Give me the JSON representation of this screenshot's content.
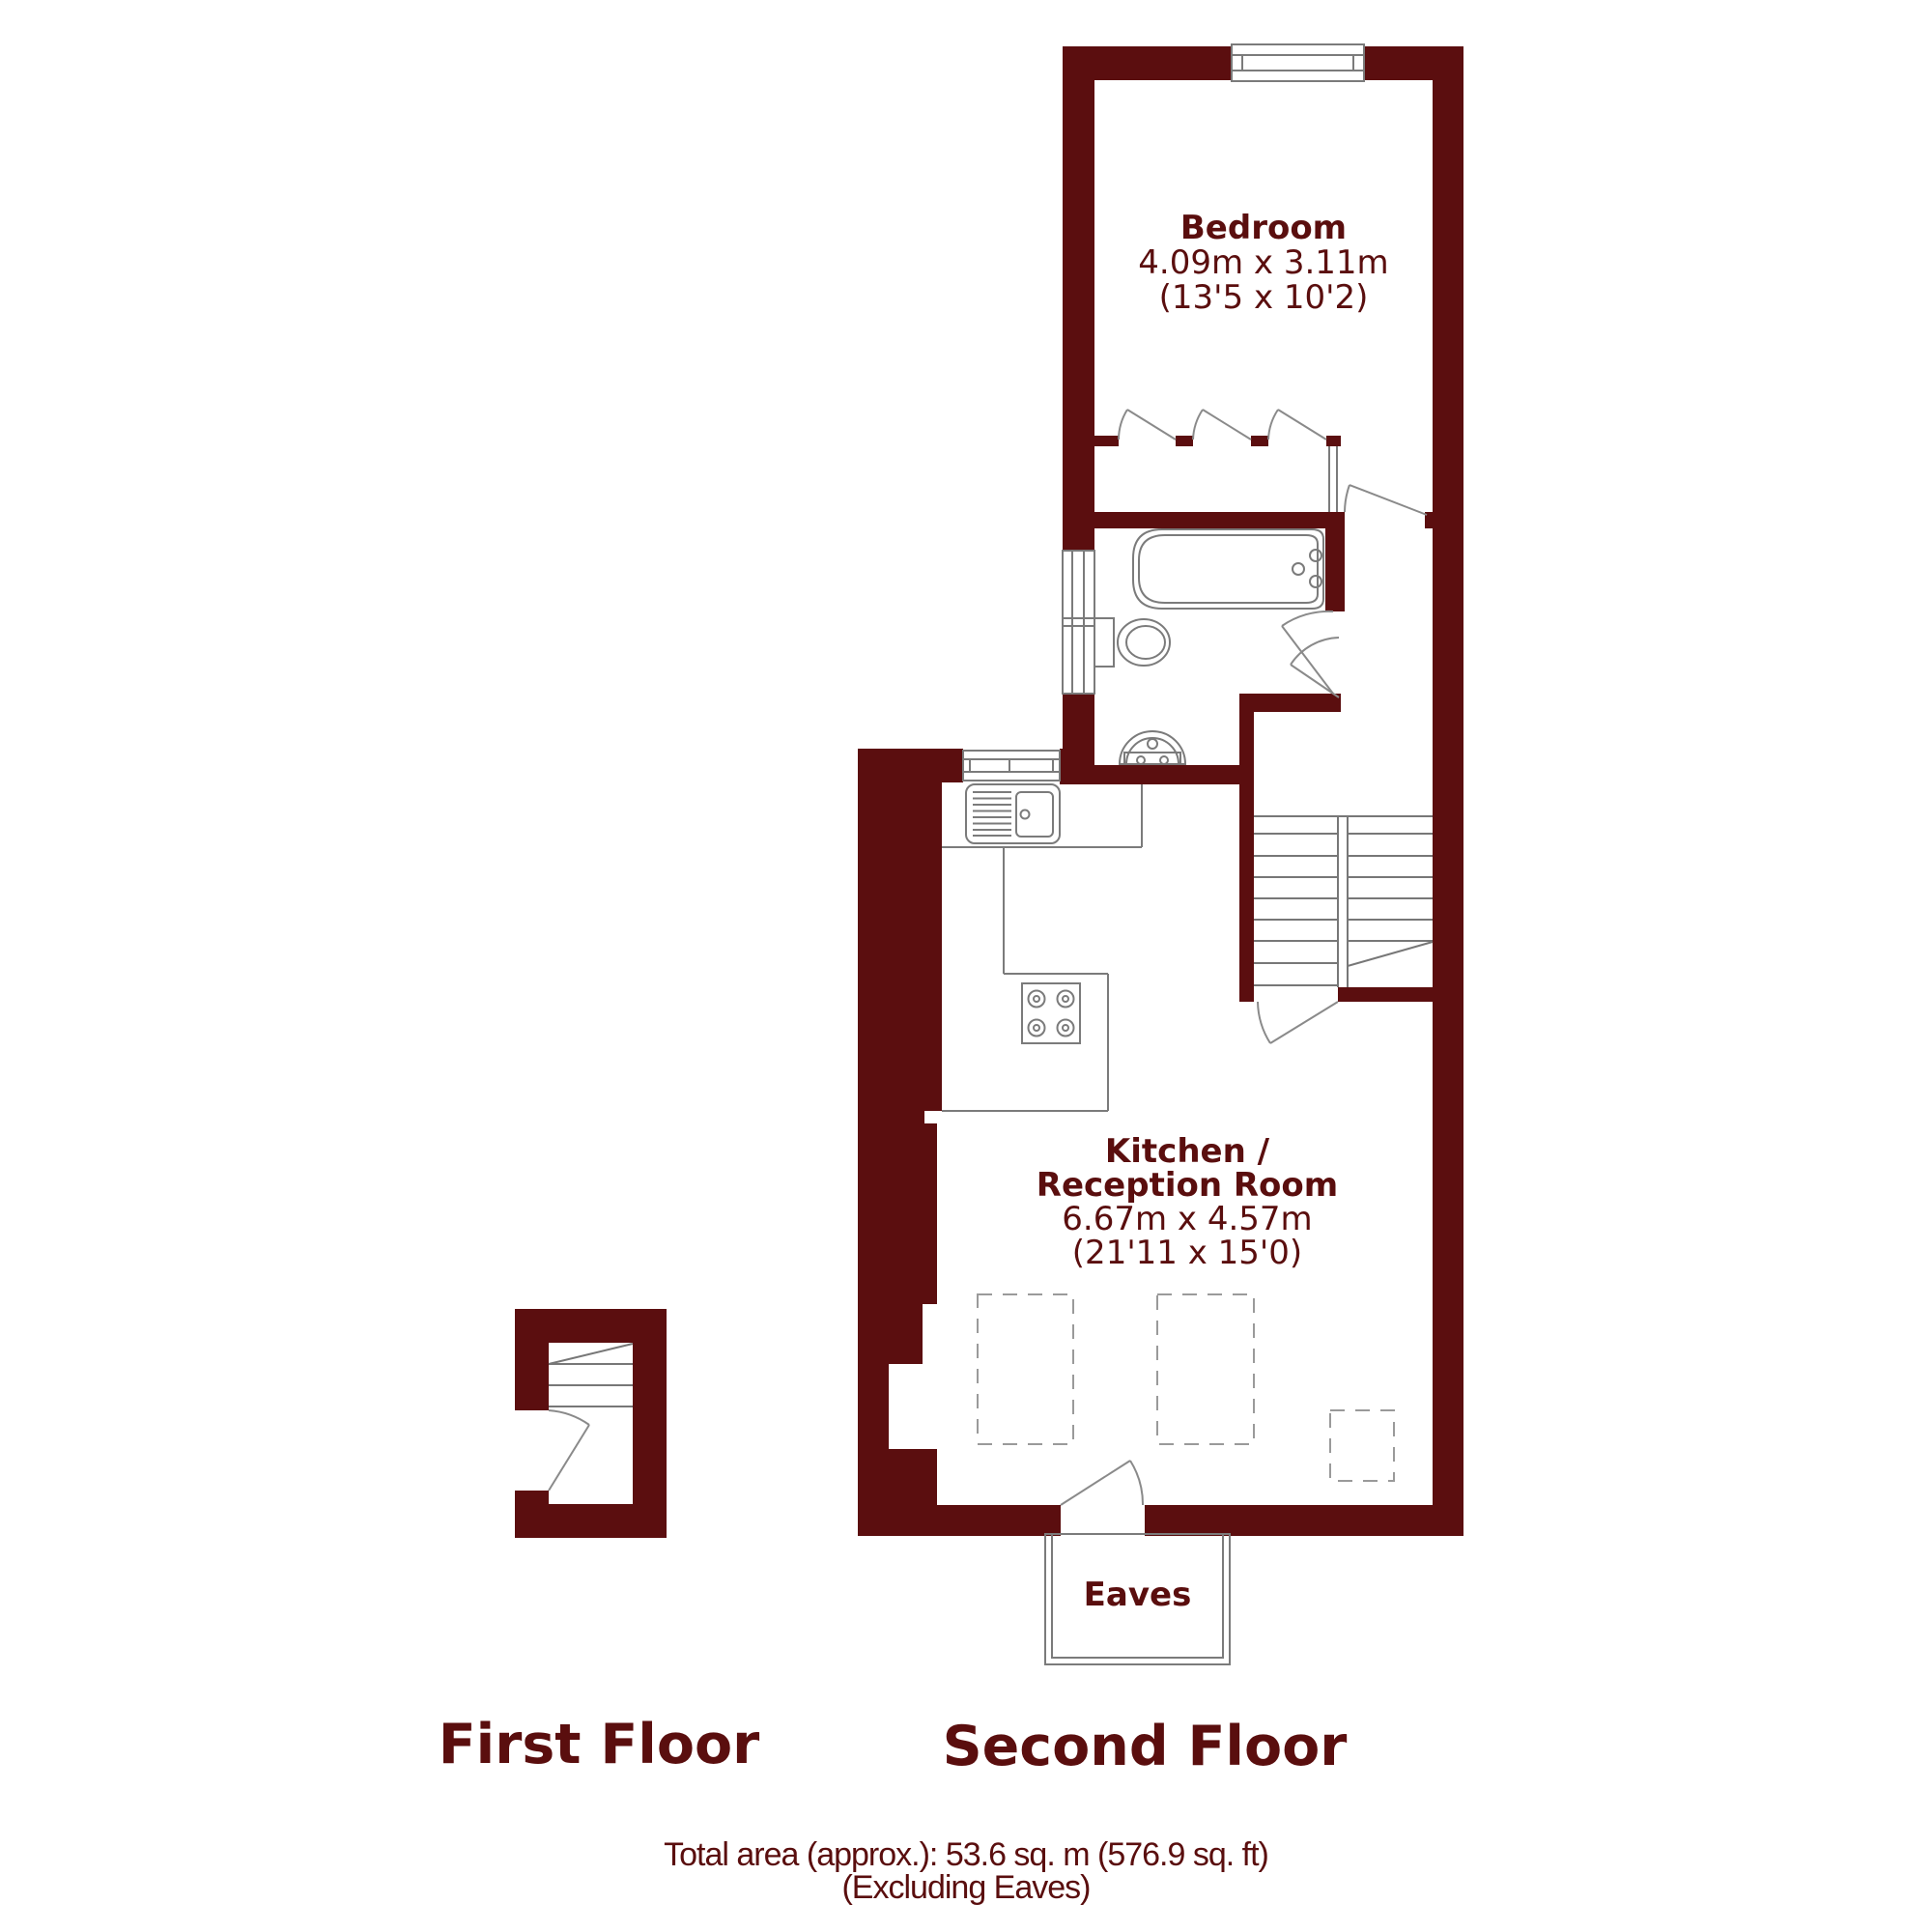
{
  "title": "Floor plan",
  "colors": {
    "wall": "#5b0e0f",
    "text": "#5a0e0e",
    "line": "#7b7b7b",
    "dash": "#9a9a9a"
  },
  "rooms": {
    "bedroom": {
      "name": "Bedroom",
      "dimensions_metric": "4.09m x 3.11m",
      "dimensions_imperial": "(13'5 x 10'2)"
    },
    "kitchen": {
      "name_line1": "Kitchen /",
      "name_line2": "Reception Room",
      "dimensions_metric": "6.67m x 4.57m",
      "dimensions_imperial": "(21'11 x 15'0)"
    },
    "eaves": {
      "name": "Eaves"
    }
  },
  "floors": {
    "first": "First Floor",
    "second": "Second Floor"
  },
  "footer": {
    "total_area": "Total area (approx.): 53.6 sq. m (576.9 sq. ft)",
    "note": "(Excluding Eaves)"
  }
}
